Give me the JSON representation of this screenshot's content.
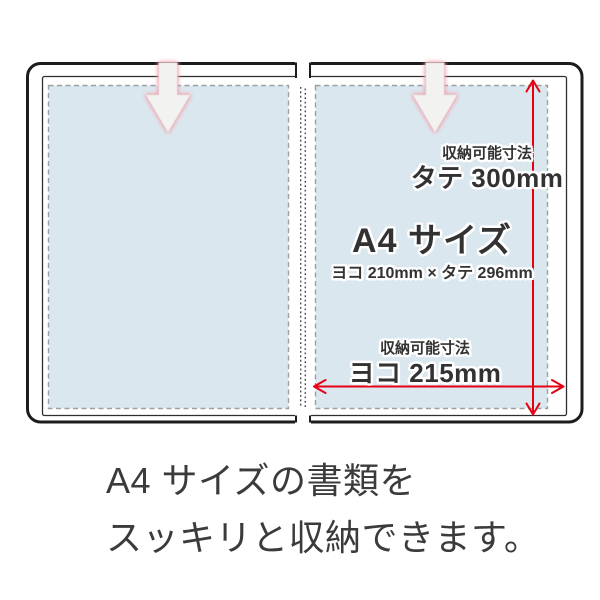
{
  "diagram": {
    "vertical_dimension": {
      "label": "収納可能寸法",
      "value": "タテ 300mm"
    },
    "paper_size": {
      "title": "A4 サイズ",
      "dimensions": "ヨコ 210mm × タテ 296mm"
    },
    "horizontal_dimension": {
      "label": "収納可能寸法",
      "value": "ヨコ 215mm"
    }
  },
  "caption": {
    "line1": "A4 サイズの書類を",
    "line2": "スッキリと収納できます。"
  },
  "icons": {
    "insert_arrow_left": "down-arrow",
    "insert_arrow_right": "down-arrow",
    "height_dimension": "vertical-double-headed-arrow",
    "width_dimension": "horizontal-double-headed-arrow"
  },
  "colors": {
    "accent_red": "#e60012",
    "pocket_blue": "#dbe7ef",
    "dashed_border_gray": "#9aa0a4",
    "folder_outline": "#1c1c1c",
    "arrow_fill": "#f2f2f0",
    "arrow_glow_pink": "#f4a0ac",
    "text_dark": "#323232"
  }
}
